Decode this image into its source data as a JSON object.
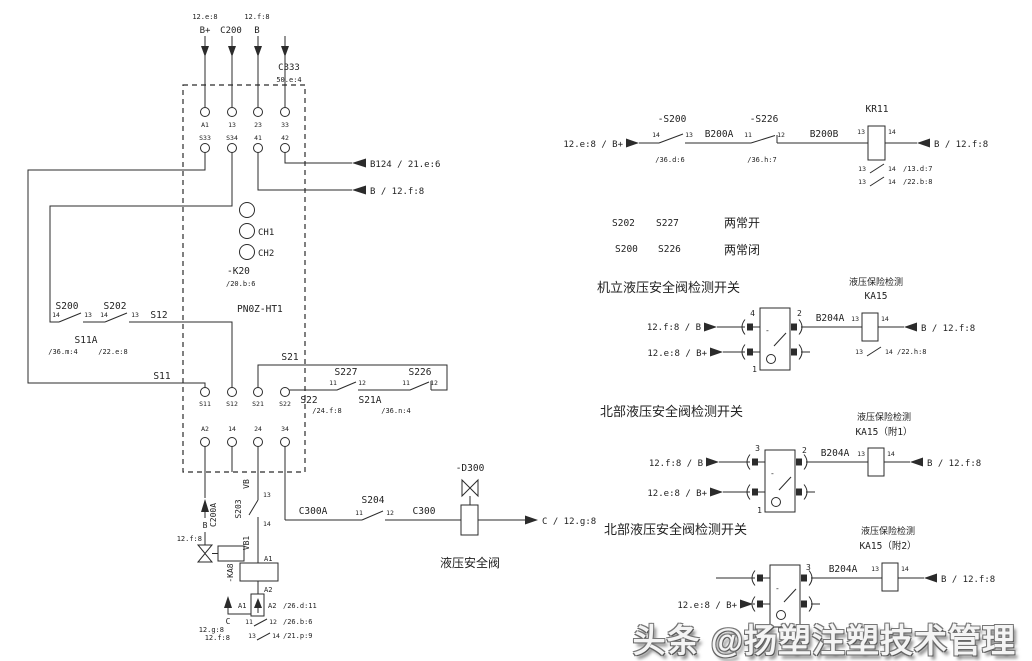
{
  "k20": {
    "title": "-K20",
    "ref": "/20.b:6",
    "model": "PN0Z-HT1",
    "ch1": "CH1",
    "ch2": "CH2",
    "top_refs": {
      "left": "12.e:8",
      "right": "12.f:8"
    },
    "inputs": [
      "B+",
      "C200",
      "B"
    ],
    "c333": {
      "name": "C333",
      "ref": "50.e:4"
    },
    "terminals_top": [
      "A1",
      "13",
      "23",
      "33"
    ],
    "terminals_mid": [
      "S33",
      "S34",
      "41",
      "42"
    ],
    "terminals_bottom": [
      "S11",
      "S12",
      "S21",
      "S22"
    ],
    "terminals_bottom2": [
      "A2",
      "14",
      "24",
      "34"
    ],
    "out_b124": "B124 / 21.e:6",
    "out_b": "B / 12.f:8"
  },
  "left_chain": {
    "s200": {
      "name": "S200",
      "t1": "14",
      "t2": "13"
    },
    "s202": {
      "name": "S202",
      "t1": "14",
      "t2": "13"
    },
    "s12": "S12",
    "s11a": {
      "name": "S11A",
      "ref1": "/36.m:4",
      "ref2": "/22.e:8"
    },
    "s11": "S11"
  },
  "s21_loop": {
    "s21": "S21",
    "s227": {
      "name": "S227",
      "t1": "11",
      "t2": "12"
    },
    "s226": {
      "name": "S226",
      "t1": "11",
      "t2": "12"
    },
    "s22": "S22",
    "s21a": {
      "name": "S21A",
      "ref1": "/24.f:8",
      "ref2": "/36.n:4"
    }
  },
  "valve_branch": {
    "b": "B",
    "b_ref": "12.f:8",
    "c200a": "C200A"
  },
  "coil_branch": {
    "vb": "VB",
    "t13": "13",
    "s203": "S203",
    "t14": "14",
    "vb1": "VB1",
    "ka8": "-KA8",
    "a1": "A1",
    "a2": "A2",
    "mini": {
      "a1": "A1",
      "a2": "A2",
      "ref": "/26.d:11",
      "c": "C",
      "ref_g": "12.g:8",
      "ref_f": "12.f:8",
      "c1": {
        "t1": "11",
        "t2": "12",
        "ref": "/26.b:6"
      },
      "c2": {
        "t1": "13",
        "t2": "14",
        "ref": "/21.p:9"
      }
    }
  },
  "c300_branch": {
    "c300a": "C300A",
    "s204": {
      "name": "S204",
      "t1": "11",
      "t2": "12"
    },
    "c300": "C300",
    "d300": "-D300",
    "caption": "液压安全阀",
    "out": "C / 12.g:8"
  },
  "kr11_row": {
    "input": "12.e:8 / B+",
    "s200": {
      "name": "-S200",
      "t1": "14",
      "t2": "13",
      "ref": "/36.d:6"
    },
    "b200a": "B200A",
    "s226": {
      "name": "-S226",
      "t1": "11",
      "t2": "12",
      "ref": "/36.h:7"
    },
    "b200b": "B200B",
    "kr11": {
      "name": "KR11",
      "t1": "13",
      "t2": "14"
    },
    "output": "B / 12.f:8",
    "c1": {
      "t1": "13",
      "t2": "14",
      "ref": "/13.d:7"
    },
    "c2": {
      "t1": "13",
      "t2": "14",
      "ref": "/22.b:8"
    }
  },
  "legend": {
    "a1": "S202",
    "a2": "S227",
    "a3": "两常开",
    "b1": "S200",
    "b2": "S226",
    "b3": "两常闭"
  },
  "blocks": [
    {
      "heading": "机立液压安全阀检测开关",
      "tag": "液压保险检测",
      "relay": "KA15",
      "in1": "12.f:8 / B",
      "in2": "12.e:8 / B+",
      "pin_a": "4",
      "pin_b": "2",
      "pin_c": "1",
      "wire": "B204A",
      "t1": "13",
      "t2": "14",
      "out": "B / 12.f:8",
      "contact": {
        "t1": "13",
        "t2": "14",
        "ref": "/22.h:8"
      }
    },
    {
      "heading": "北部液压安全阀检测开关",
      "tag": "液压保险检测",
      "relay": "KA15（附1）",
      "in1": "12.f:8 / B",
      "in2": "12.e:8 / B+",
      "pin_a": "3",
      "pin_b": "2",
      "pin_c": "1",
      "wire": "B204A",
      "t1": "13",
      "t2": "14",
      "out": "B / 12.f:8"
    },
    {
      "heading": "北部液压安全阀检测开关",
      "tag": "液压保险检测",
      "relay": "KA15（附2）",
      "in2": "12.e:8 / B+",
      "pin_b": "3",
      "wire": "B204A",
      "t1": "13",
      "t2": "14",
      "out": "B / 12.f:8"
    }
  ],
  "watermark": "头条 @扬塑注塑技术管理"
}
